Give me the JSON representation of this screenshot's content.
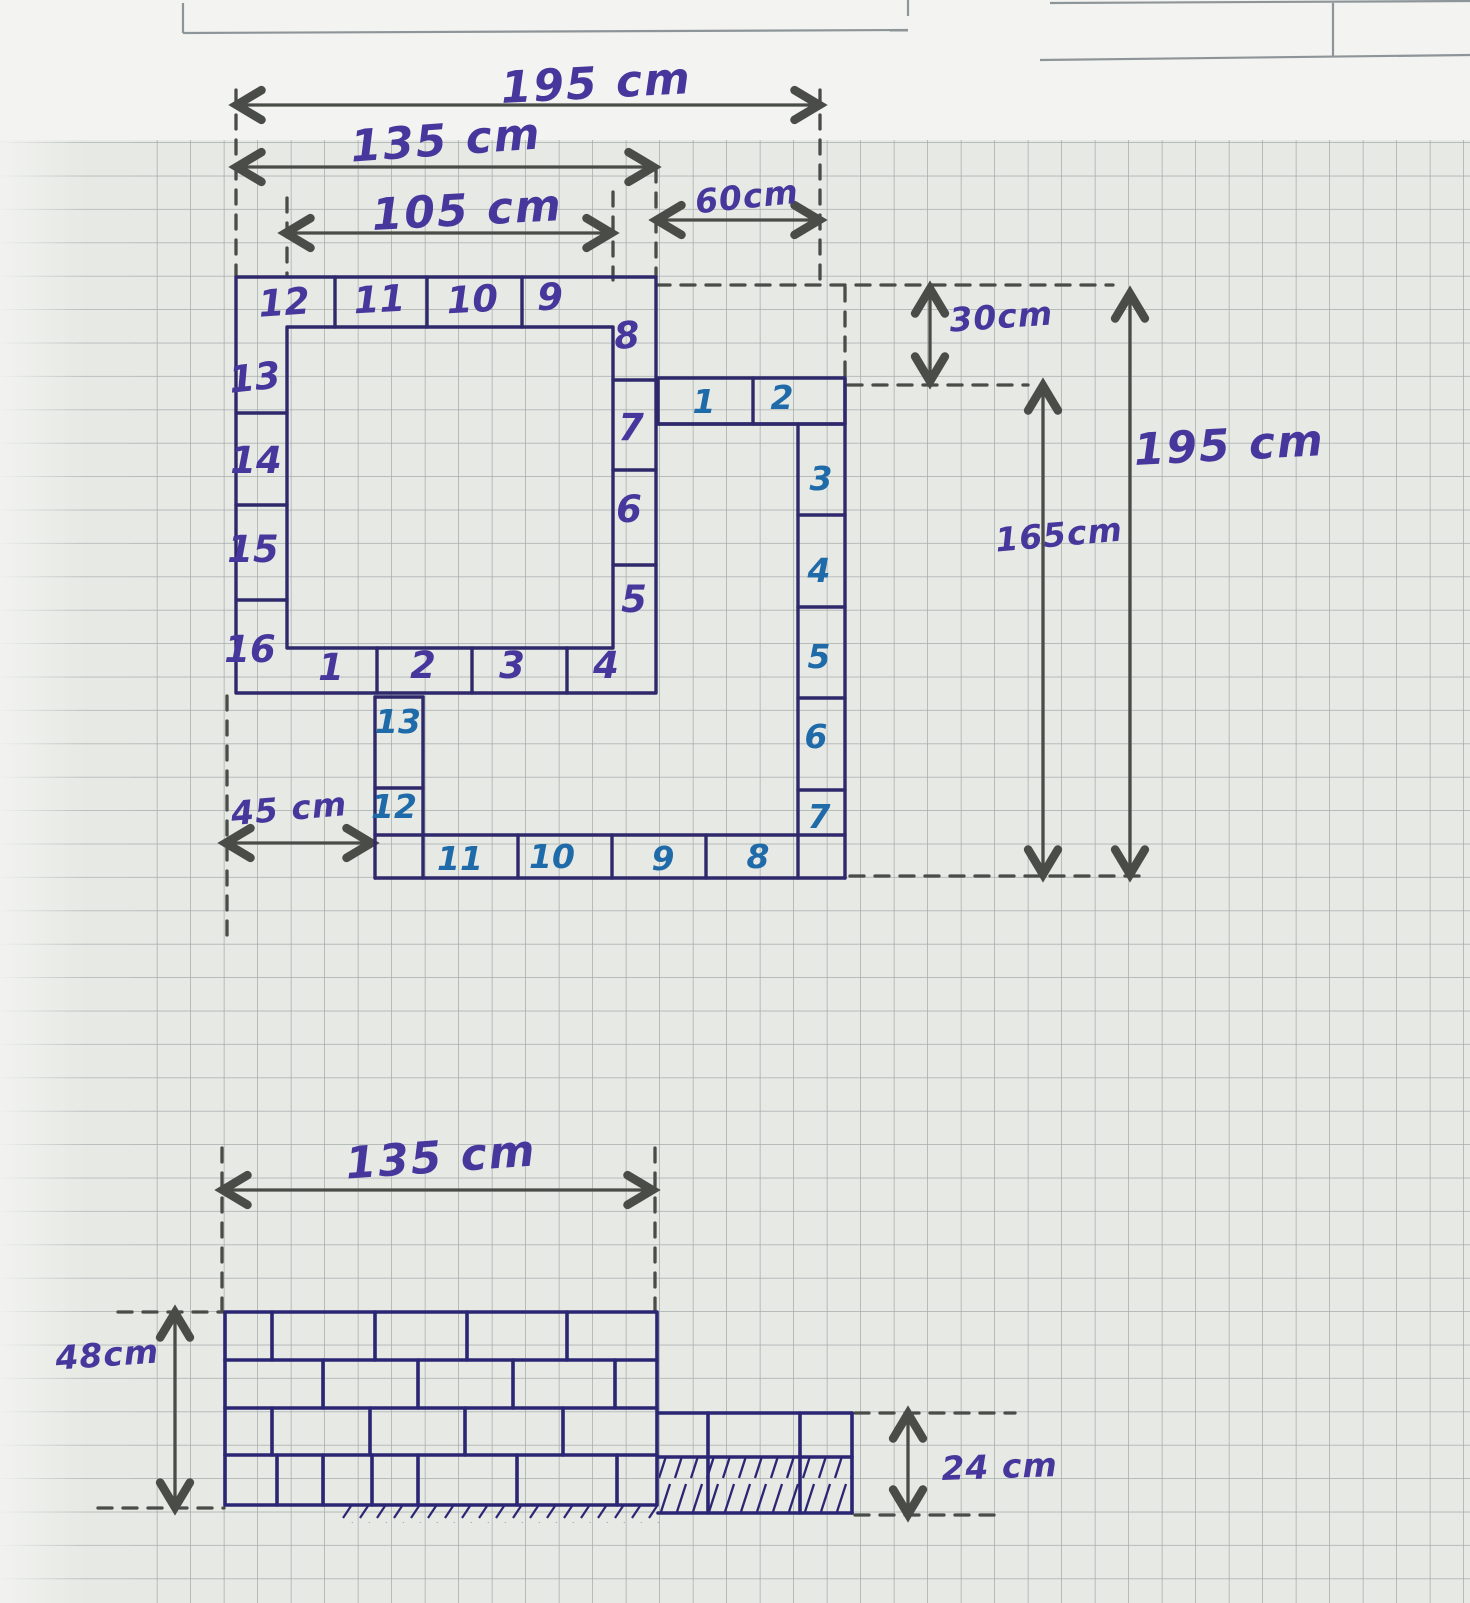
{
  "figure_top": {
    "dimensions": {
      "total_width": "195 cm",
      "main_width": "135 cm",
      "inner_width": "105 cm",
      "nook_width": "60cm",
      "nook_height": "30cm",
      "total_height": "195 cm",
      "inner_height": "165cm",
      "bottom_offset": "45 cm"
    },
    "border_tiles": {
      "top_row": [
        "12",
        "11",
        "10",
        "9"
      ],
      "right_column": [
        "8",
        "7",
        "6",
        "5"
      ],
      "bottom_row": [
        "1",
        "2",
        "3",
        "4"
      ],
      "left_column": [
        "13",
        "14",
        "15",
        "16"
      ]
    },
    "strip_tiles": {
      "top_row": [
        "1",
        "2"
      ],
      "right_column": [
        "3",
        "4",
        "5",
        "6",
        "7"
      ],
      "bottom_row": [
        "11",
        "10",
        "9",
        "8"
      ],
      "left_column": [
        "13",
        "12"
      ]
    }
  },
  "figure_bottom": {
    "dimensions": {
      "width": "135 cm",
      "height": "48cm",
      "strip_height": "24 cm"
    }
  },
  "colors": {
    "paper": "#e7e9e4",
    "top_sheet": "#f3f4f1",
    "grid_line": "#6e7a7e",
    "pencil": "#4a4c48",
    "ink_outline": "#2e296b",
    "ink_purple_text": "#47379c",
    "ink_blue_text": "#1f6aa8"
  }
}
